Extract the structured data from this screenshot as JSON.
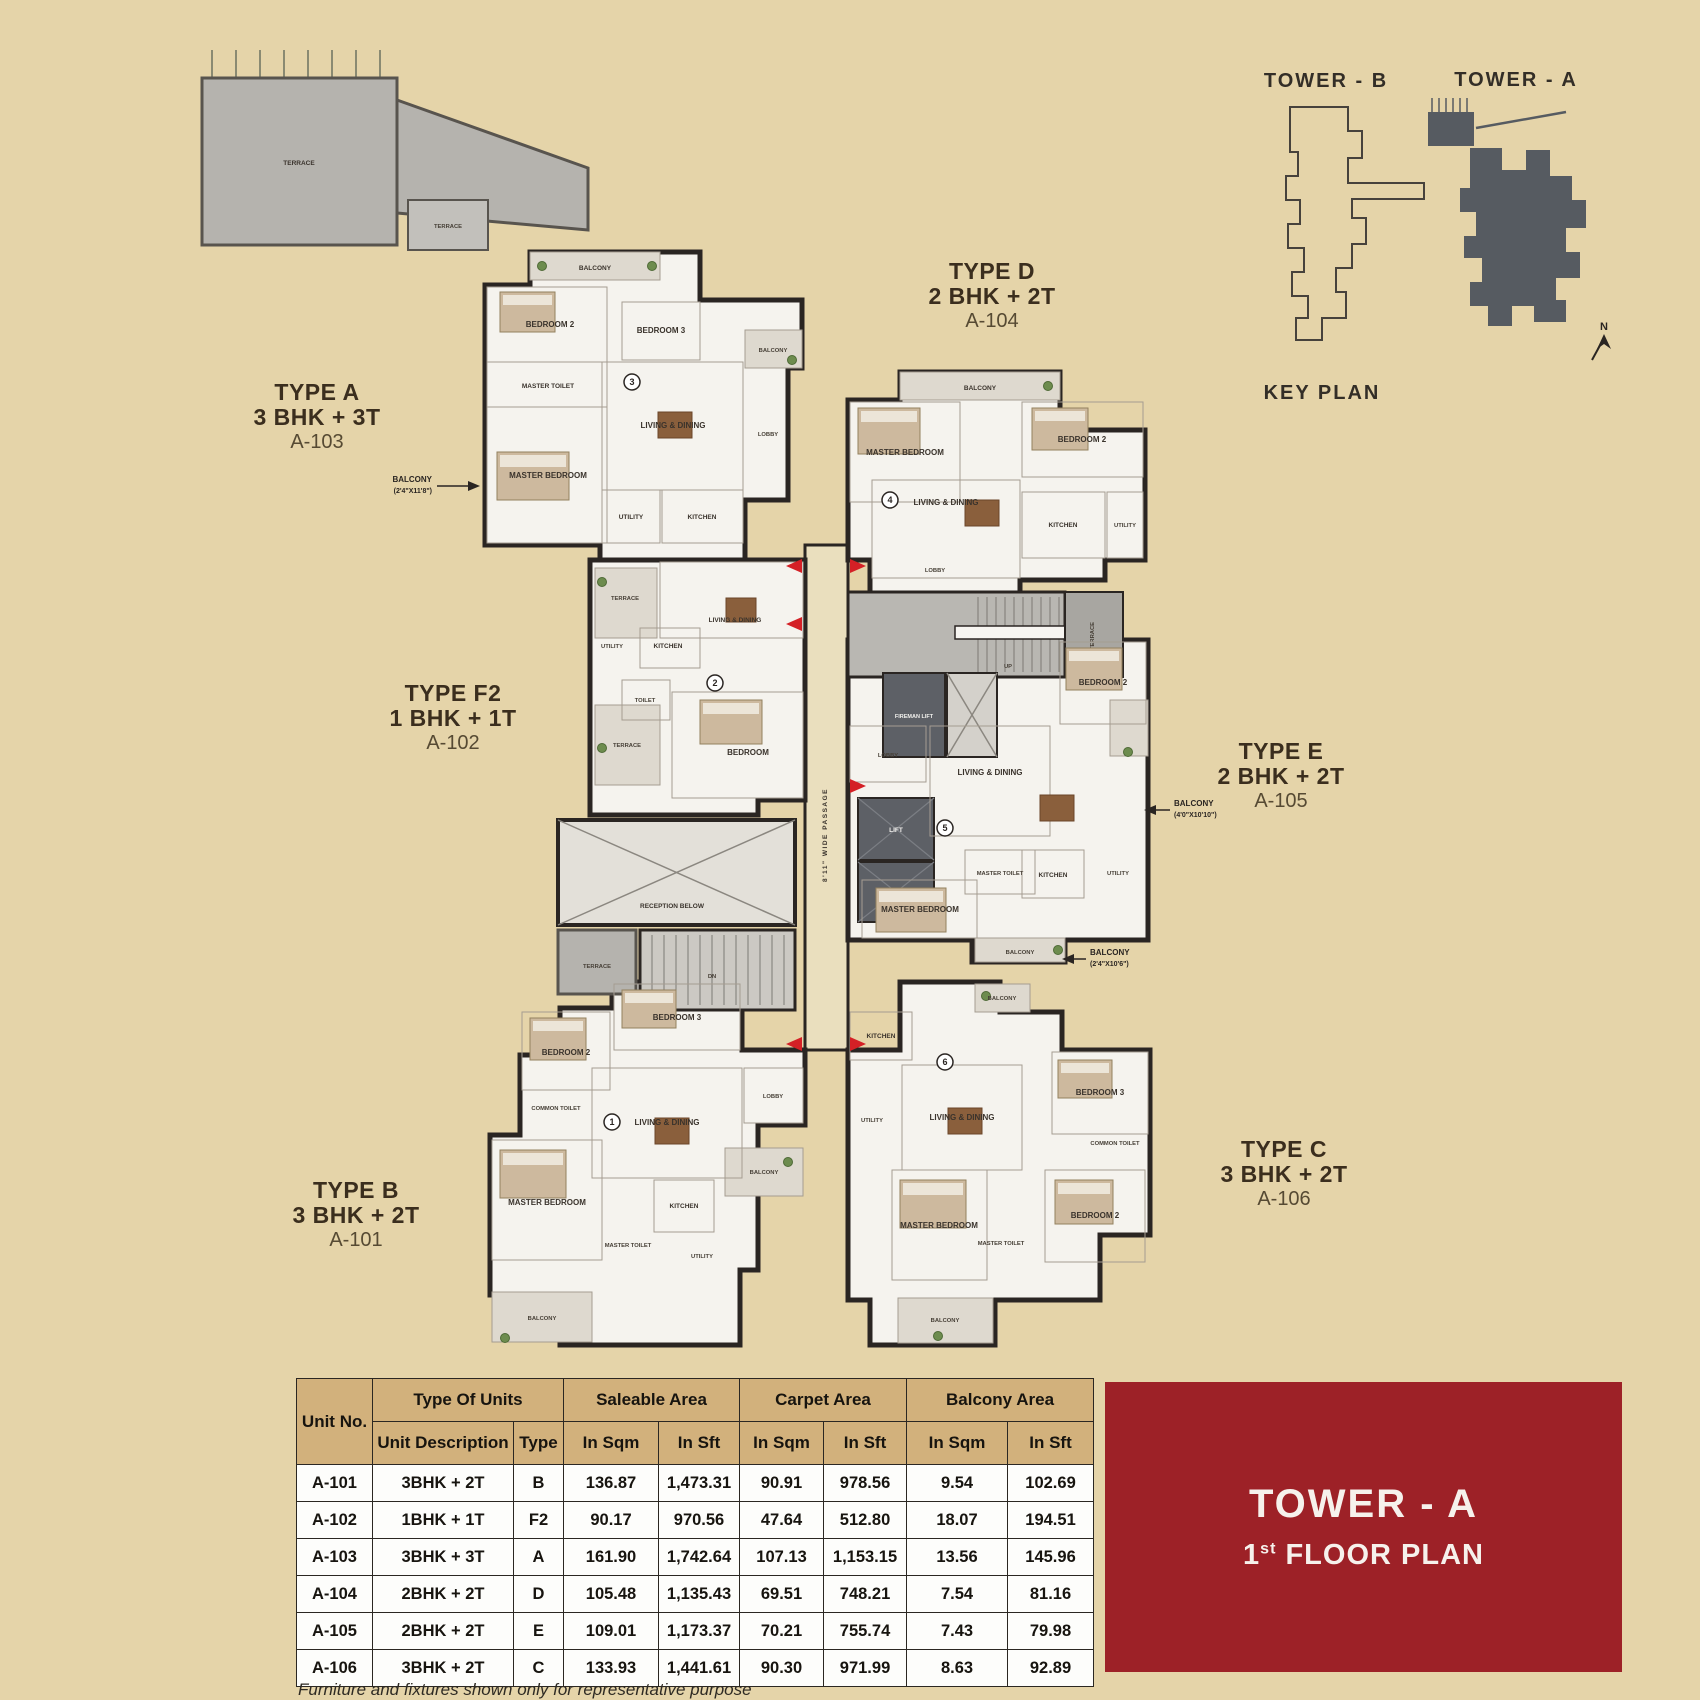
{
  "colors": {
    "page_bg": "#e5d4a9",
    "table_header": "#d2b17c",
    "title_box_red": "#9d2127",
    "keyplan_dark": "#565b61",
    "door_arrow_red": "#d42026"
  },
  "key_plan": {
    "tower_b": "TOWER - B",
    "tower_a": "TOWER - A",
    "title": "KEY PLAN",
    "north": "N"
  },
  "type_labels": [
    {
      "line1": "TYPE A",
      "line2": "3 BHK + 3T",
      "line3": "A-103"
    },
    {
      "line1": "TYPE D",
      "line2": "2 BHK + 2T",
      "line3": "A-104"
    },
    {
      "line1": "TYPE F2",
      "line2": "1 BHK + 1T",
      "line3": "A-102"
    },
    {
      "line1": "TYPE E",
      "line2": "2 BHK + 2T",
      "line3": "A-105"
    },
    {
      "line1": "TYPE B",
      "line2": "3 BHK + 2T",
      "line3": "A-101"
    },
    {
      "line1": "TYPE C",
      "line2": "3 BHK + 2T",
      "line3": "A-106"
    }
  ],
  "floorplan": {
    "rooms": {
      "balcony": "BALCONY",
      "bedroom": "BEDROOM",
      "bedroom2": "BEDROOM 2",
      "bedroom3": "BEDROOM 3",
      "master_bedroom": "MASTER BEDROOM",
      "master_toilet": "MASTER TOILET",
      "common_toilet": "COMMON TOILET",
      "toilet": "TOILET",
      "living_dining": "LIVING & DINING",
      "kitchen": "KITCHEN",
      "utility": "UTILITY",
      "lobby": "LOBBY",
      "terrace": "TERRACE",
      "lift": "LIFT",
      "fireman_lift": "FIREMAN LIFT",
      "passage": "8'11\" WIDE PASSAGE",
      "reception": "RECEPTION BELOW",
      "up": "UP",
      "dn": "DN"
    },
    "unit_marks": [
      "1",
      "2",
      "3",
      "4",
      "5",
      "6"
    ]
  },
  "annotations": {
    "balcony_a": {
      "label": "BALCONY",
      "dim": "(2'4\"X11'8\")"
    },
    "balcony_e": {
      "label": "BALCONY",
      "dim": "(4'0\"X10'10\")"
    },
    "balcony_c": {
      "label": "BALCONY",
      "dim": "(2'4\"X10'6\")"
    }
  },
  "table": {
    "header": {
      "unit_no": "Unit No.",
      "type_of_units": "Type Of Units",
      "saleable": "Saleable Area",
      "carpet": "Carpet Area",
      "balcony": "Balcony Area",
      "sub": [
        "Unit Description",
        "Type",
        "In Sqm",
        "In Sft",
        "In Sqm",
        "In Sft",
        "In Sqm",
        "In Sft"
      ]
    },
    "rows": [
      [
        "A-101",
        "3BHK + 2T",
        "B",
        "136.87",
        "1,473.31",
        "90.91",
        "978.56",
        "9.54",
        "102.69"
      ],
      [
        "A-102",
        "1BHK + 1T",
        "F2",
        "90.17",
        "970.56",
        "47.64",
        "512.80",
        "18.07",
        "194.51"
      ],
      [
        "A-103",
        "3BHK + 3T",
        "A",
        "161.90",
        "1,742.64",
        "107.13",
        "1,153.15",
        "13.56",
        "145.96"
      ],
      [
        "A-104",
        "2BHK + 2T",
        "D",
        "105.48",
        "1,135.43",
        "69.51",
        "748.21",
        "7.54",
        "81.16"
      ],
      [
        "A-105",
        "2BHK + 2T",
        "E",
        "109.01",
        "1,173.37",
        "70.21",
        "755.74",
        "7.43",
        "79.98"
      ],
      [
        "A-106",
        "3BHK + 2T",
        "C",
        "133.93",
        "1,441.61",
        "90.30",
        "971.99",
        "8.63",
        "92.89"
      ]
    ]
  },
  "title_box": {
    "line1": "TOWER - A",
    "sup_num": "1",
    "sup": "st",
    "rest": " FLOOR PLAN"
  },
  "footer_note": "Furniture and fixtures shown only for representative purpose"
}
